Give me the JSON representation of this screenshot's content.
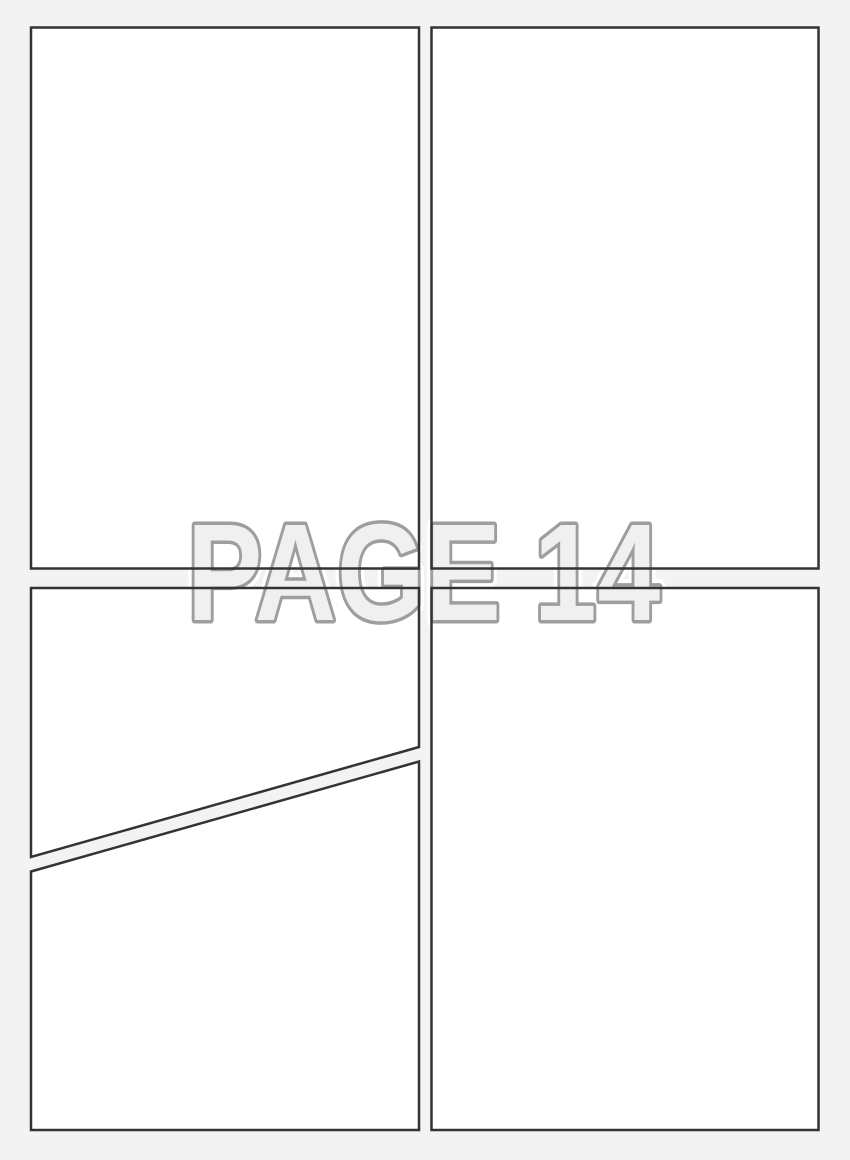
{
  "page_label": {
    "text": "PAGE 14"
  },
  "panels": {
    "count": 5,
    "names": [
      "top-left",
      "top-right",
      "bottom-left-upper-diagonal",
      "bottom-left-lower-diagonal",
      "bottom-right"
    ]
  },
  "colors": {
    "page_background": "#f3f3f3",
    "panel_fill": "#ffffff",
    "panel_border": "#333333",
    "label_fill": "#f0f0f0",
    "label_outline": "#9e9e9e",
    "label_halo": "#ffffff"
  }
}
